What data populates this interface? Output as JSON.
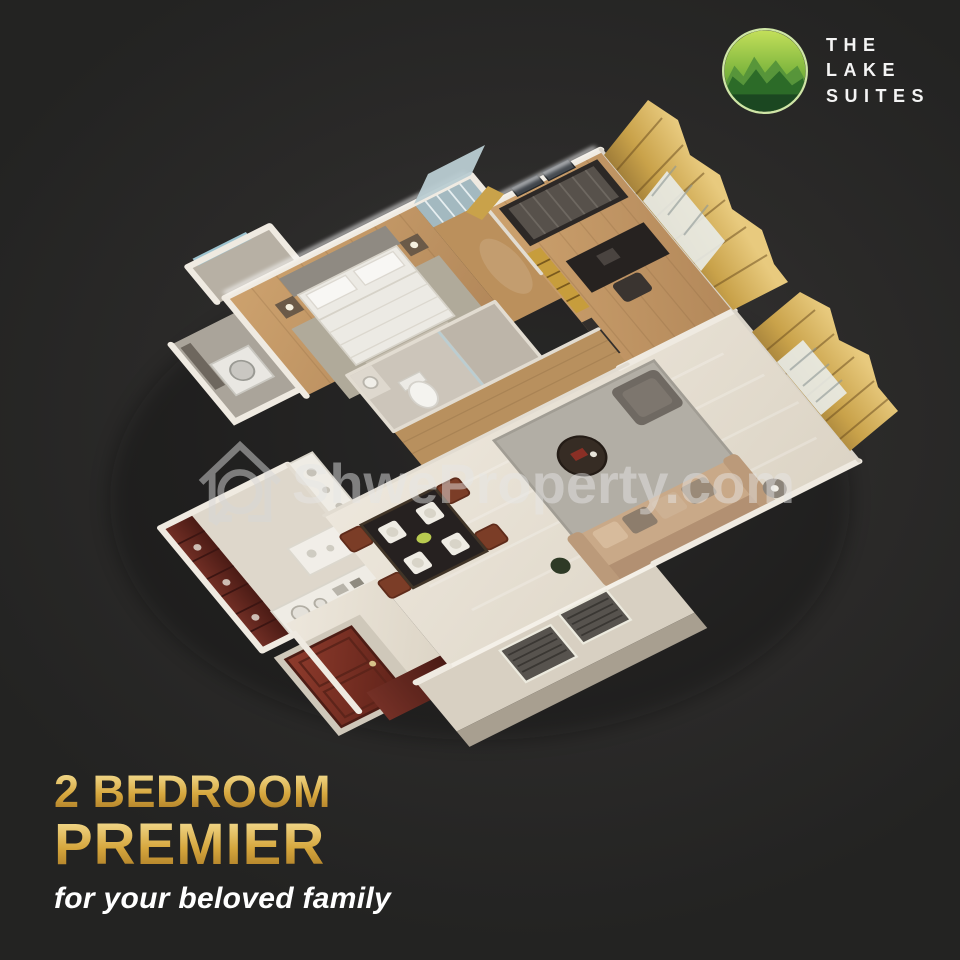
{
  "brand": {
    "name_lines": [
      "THE",
      "LAKE",
      "SUITES"
    ],
    "logo_icon": "mountains-in-circle-icon"
  },
  "watermark": {
    "icon": "house-magnifier-icon",
    "text": "ShweProperty.com"
  },
  "caption": {
    "line1": "2 BEDROOM",
    "line2": "PREMIER",
    "tagline": "for your beloved family"
  },
  "floorplan": {
    "type": "3d-dollhouse-render",
    "unit": "2 bedroom apartment",
    "rooms": [
      "master-bedroom",
      "second-bedroom",
      "living-room",
      "dining-area",
      "kitchen",
      "master-bathroom",
      "bathroom",
      "utility-room",
      "corridor-wardrobe",
      "entrance-foyer",
      "balcony-ac-ledge"
    ]
  },
  "colors": {
    "background": "#232323",
    "gold_headline": "#d6a73e",
    "logo_green_light": "#c3df5a",
    "logo_green_dark": "#2f7229",
    "curtain_gold": "#c9a24a",
    "wood_floor": "#c49a66",
    "marble_floor": "#e7e1d6",
    "kitchen_cabinet_maroon": "#6b2a23",
    "entrance_door_red": "#8a382a",
    "watermark_gray": "#dcdcdc"
  }
}
